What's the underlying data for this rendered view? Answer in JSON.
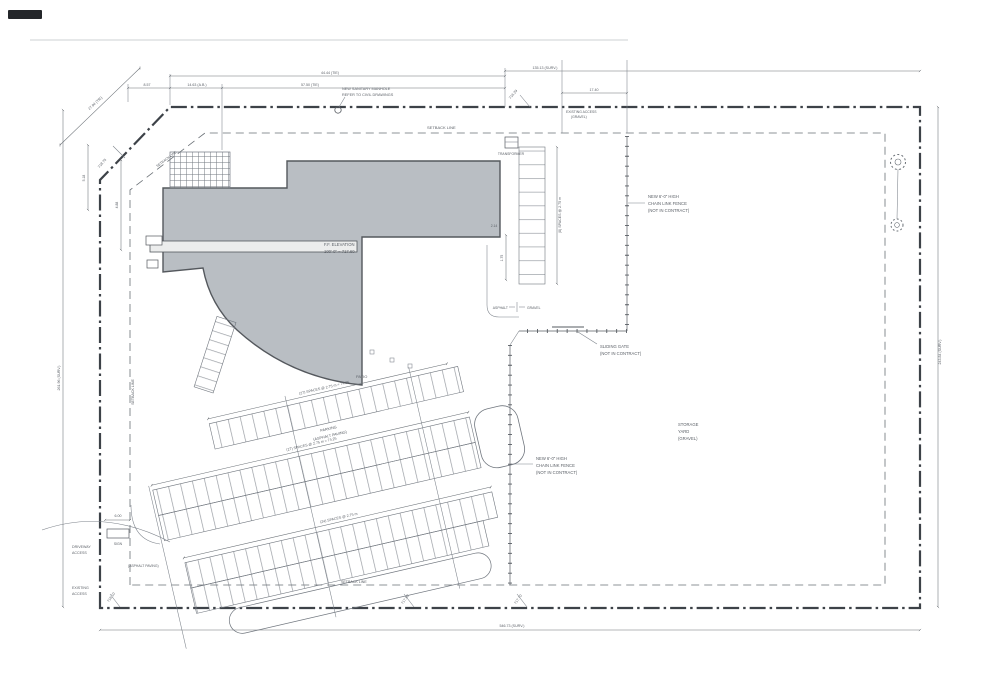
{
  "drawing_type": "architectural site plan",
  "labels": {
    "setback_top": "SETBACK LINE",
    "setback_left": "SETBACK LINE",
    "setback_bottom": "SETBACK LINE",
    "setback_diag": "SETBACK LINE",
    "ff_line1": "F.F. ELEVATION",
    "ff_line2": "100'-0\" = 717.60",
    "patio": "PATIO",
    "parking_line1": "PARKING",
    "parking_line2": "(ASPHALT PAVING)",
    "storage_line1": "STORAGE",
    "storage_line2": "YARD",
    "storage_line3": "(GRAVEL)",
    "fence_line1": "NEW 6'-0\" HIGH",
    "fence_line2": "CHAIN LINK FENCE",
    "fence_line3": "(NOT IN CONTRACT)",
    "gate_line1": "SLIDING GATE",
    "gate_line2": "(NOT IN CONTRACT)",
    "manhole_line1": "NEW SANITARY MANHOLE",
    "manhole_line2": "REFER TO CIVIL DRAWINGS",
    "driveway_line1": "DRIVEWAY",
    "driveway_line2": "ACCESS",
    "existing_line1": "EXISTING",
    "existing_line2": "ACCESS",
    "exist_access_line1": "EXISTING ACCESS",
    "exist_access_line2": "(GRAVEL)",
    "asphalt": "ASPHALT",
    "gravel": "GRAVEL",
    "sign": "SIGN",
    "transformer": "TRANSFORMER"
  },
  "dims": [
    "8.57",
    "14.63 (A.B.)",
    "57.50 (TIE)",
    "44.44 (TIE)",
    "135.13 (SURV.)",
    "17.40",
    "27.94 (TIE)",
    "243.84 (SURV.)",
    "261.96 (SURV.)",
    "546.73 (SURV.)",
    "(8) SPACES @ 2.75 m",
    "(27) SPACES @ 2.75 m = 74.25",
    "(27) SPACES @ 2.75 m = 74.25",
    "(24) SPACES @ 2.75 m",
    "6.00",
    "2.14",
    "1.75",
    "4.88",
    "5.18"
  ],
  "spots": [
    "718.75",
    "716.29",
    "718.10",
    "717.80",
    "717.70"
  ],
  "colors": {
    "line": "#565b61",
    "property_line": "#3d4248",
    "building_fill": "#b9bec3",
    "building_edge": "#54585d",
    "text": "#5a5f66"
  }
}
